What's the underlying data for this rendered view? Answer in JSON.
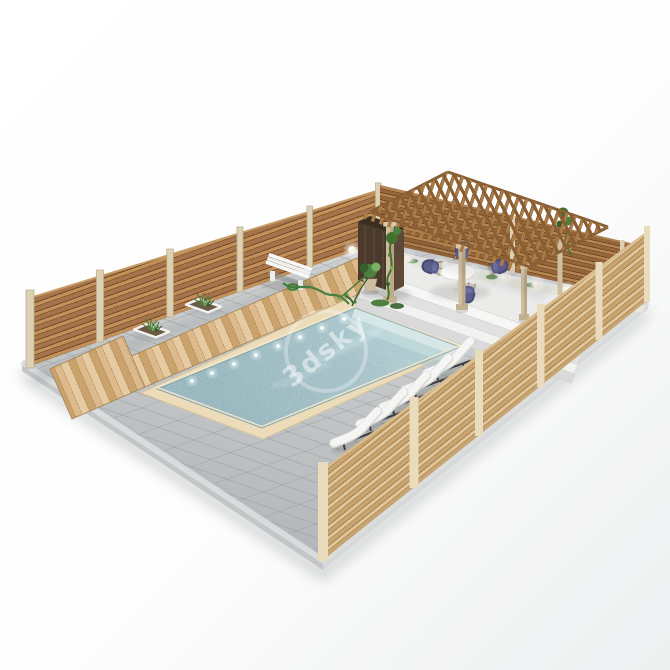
{
  "scene": {
    "title": "3D render of a backyard swimming pool yard with wooden fence and pergola",
    "background": "#ffffff",
    "watermark": {
      "text": "3dsky",
      "color": "#ffffff"
    },
    "palette": {
      "paver_top": "#d0d2d3",
      "paver_bottom": "#b6b9bb",
      "coping": "#ecdcba",
      "water_mid": "#93b7be",
      "terrace": "#ebebe9",
      "cushion": "#f5f5f3",
      "frame": "#3b3e41",
      "chair": "#5b5e8d",
      "bench": "#f7f8f8",
      "green": "#4e8040",
      "green_dark": "#35602c",
      "green_light": "#7ab062",
      "hose": "#3e7d3c",
      "lamp": "#f7f4e8",
      "stone": "#cfc0a0",
      "stone_shade": "#b3a17f",
      "pergola": "#a87b47",
      "pergola_dark": "#8a5f33",
      "post": "#ddd1b3",
      "shower": "#4a392c",
      "shower_side": "#5d4936",
      "shower_top": "#3a2d22",
      "gravel": "#e6e8dc"
    },
    "objects": {
      "pavers": {
        "label": "Grey paver patio platform"
      },
      "fence": {
        "label": "Horizontal-slat wooden fence",
        "sides": 3,
        "posts_nw": 6,
        "posts_se": 6
      },
      "deck": {
        "label": "Wooden deck walkway along pool"
      },
      "pool": {
        "label": "Rectangular swimming pool",
        "underwater_lights": 8,
        "submerged_steps": 3
      },
      "terrace": {
        "label": "Raised pergola terrace",
        "steps": 4
      },
      "pergola": {
        "label": "Wooden lattice pergola",
        "columns": 3,
        "pilasters": 1
      },
      "dining_set": {
        "label": "Round white table with chairs",
        "chairs": 4
      },
      "sun_loungers": {
        "label": "White sun loungers",
        "count": 5
      },
      "bench": {
        "label": "White slatted bench"
      },
      "garden_hose": {
        "label": "Green garden hose"
      },
      "planters": {
        "label": "Square in-ground planters",
        "count": 2
      },
      "potted_plant": {
        "label": "Potted plant with trailing vine"
      },
      "sphere_lamps": {
        "label": "White sphere lamps",
        "count": 9
      },
      "shower_cabinet": {
        "label": "Dark outdoor shower cabinet"
      },
      "vines": {
        "label": "Climbing vines",
        "count": 3
      }
    }
  }
}
